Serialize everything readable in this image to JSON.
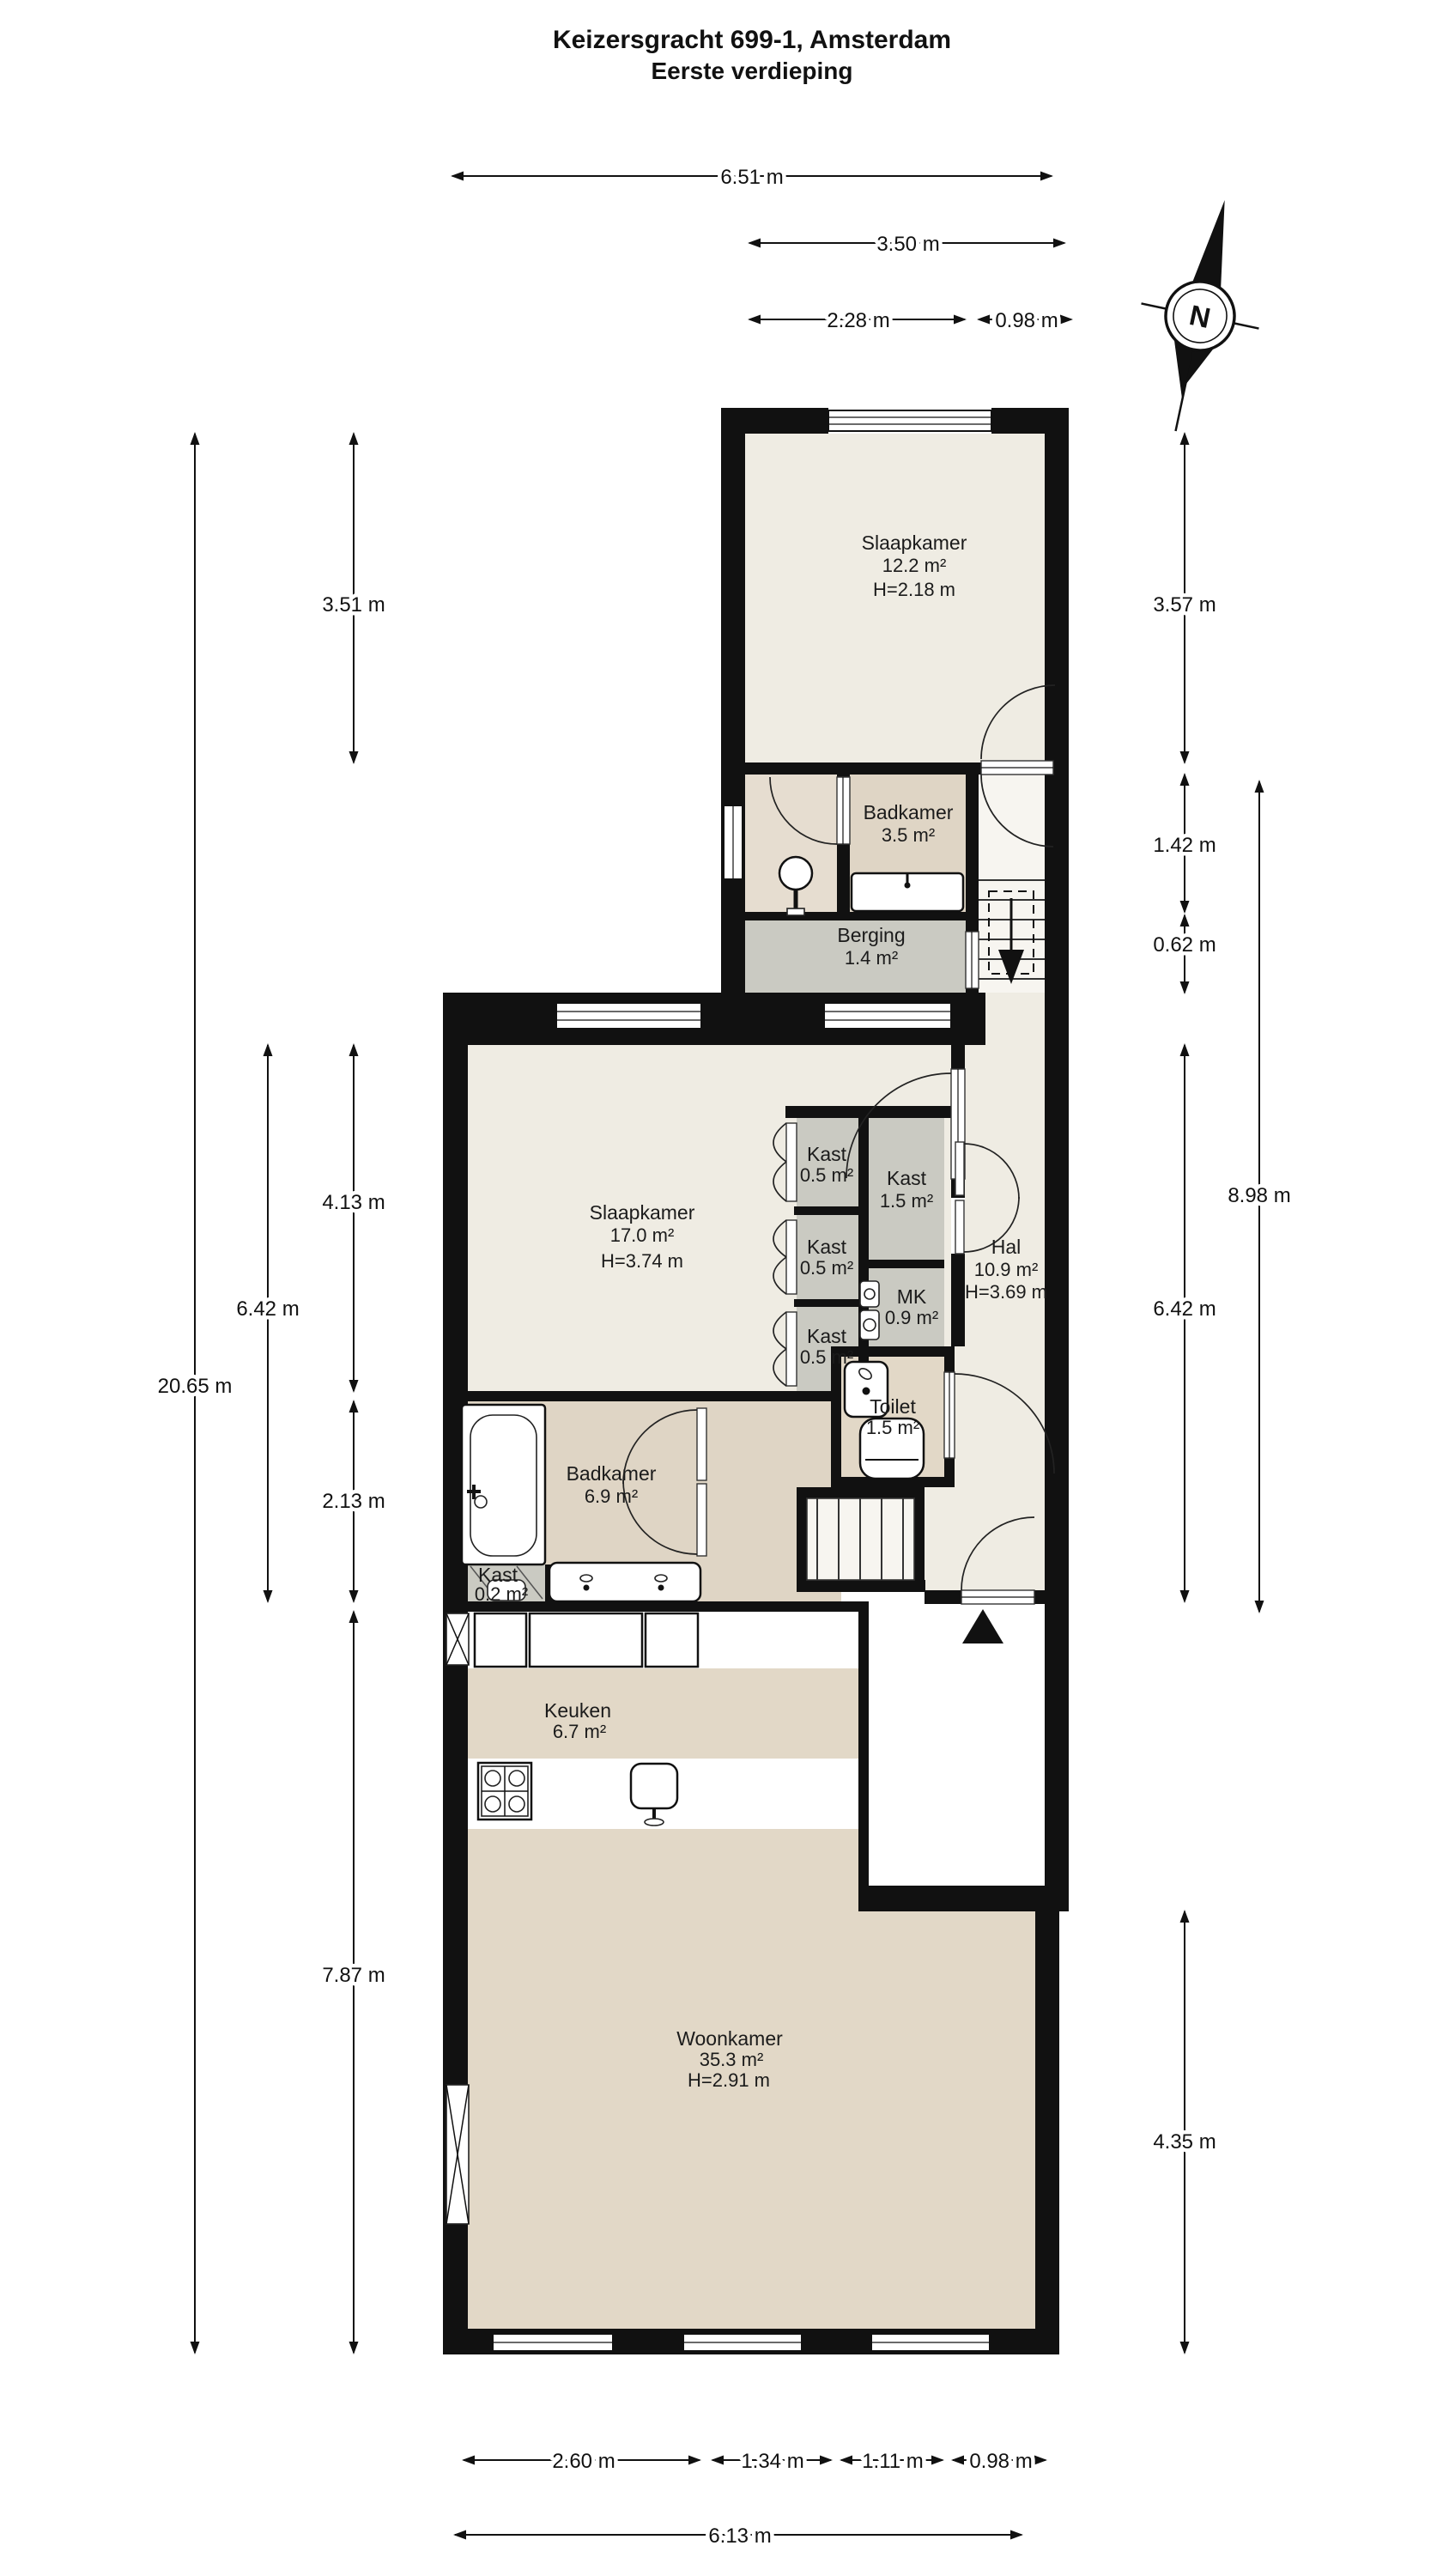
{
  "title": {
    "line1": "Keizersgracht 699-1, Amsterdam",
    "line2": "Eerste verdieping"
  },
  "compass": {
    "north_label": "N"
  },
  "rooms": {
    "slaapkamer_boven": {
      "name": "Slaapkamer",
      "area": "12.2 m²",
      "height": "H=2.18 m"
    },
    "badkamer_boven": {
      "name": "Badkamer",
      "area": "3.5 m²"
    },
    "berging": {
      "name": "Berging",
      "area": "1.4 m²"
    },
    "slaapkamer": {
      "name": "Slaapkamer",
      "area": "17.0 m²",
      "height": "H=3.74 m"
    },
    "kast_1": {
      "name": "Kast",
      "area": "0.5 m²"
    },
    "kast_2": {
      "name": "Kast",
      "area": "0.5 m²"
    },
    "kast_3": {
      "name": "Kast",
      "area": "0.5 m²"
    },
    "kast_groot": {
      "name": "Kast",
      "area": "1.5 m²"
    },
    "hal": {
      "name": "Hal",
      "area": "10.9 m²",
      "height": "H=3.69 m"
    },
    "mk": {
      "name": "MK",
      "area": "0.9 m²"
    },
    "toilet": {
      "name": "Toilet",
      "area": "1.5 m²"
    },
    "badkamer": {
      "name": "Badkamer",
      "area": "6.9 m²"
    },
    "kast_klein": {
      "name": "Kast",
      "area": "0.2 m²"
    },
    "keuken": {
      "name": "Keuken",
      "area": "6.7 m²"
    },
    "woonkamer": {
      "name": "Woonkamer",
      "area": "35.3 m²",
      "height": "H=2.91 m"
    }
  },
  "dimensions": {
    "top": {
      "total": "6.51 m",
      "block": "3.50 m",
      "left_part": "2.28 m",
      "right_part": "0.98 m"
    },
    "bottom": {
      "w1": "2.60 m",
      "w2": "1.34 m",
      "w3": "1.11 m",
      "w4": "0.98 m",
      "total": "6.13 m"
    },
    "left": {
      "top": "3.51 m",
      "bedroom": "4.13 m",
      "bathroom": "2.13 m",
      "lower": "7.87 m",
      "middle": "6.42 m",
      "total": "20.65 m"
    },
    "right": {
      "top": "3.57 m",
      "bath": "1.42 m",
      "storage": "0.62 m",
      "middle": "6.42 m",
      "upper_total": "8.98 m",
      "living": "4.35 m"
    }
  },
  "colors": {
    "wall": "#111111",
    "floor_light": "#efece3",
    "floor_tan": "#e2d8c7",
    "floor_dark_tan": "#dfd5c5",
    "floor_rose": "#e6ddd0",
    "floor_gray": "#cacac2",
    "background": "#ffffff"
  }
}
